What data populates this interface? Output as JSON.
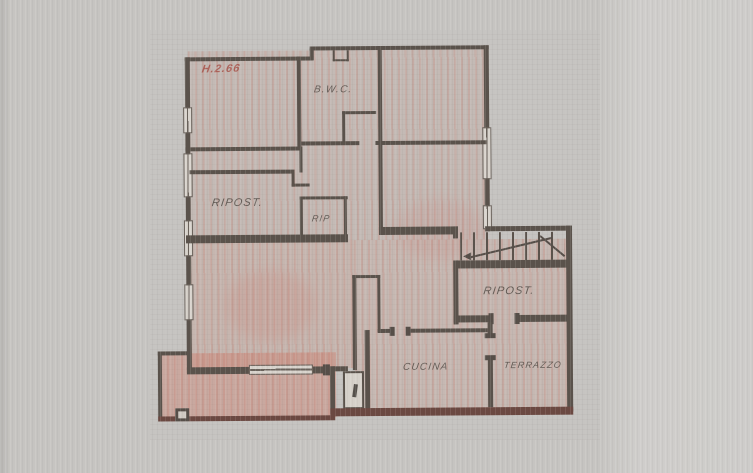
{
  "plan": {
    "annotation": {
      "text": "H.2.66",
      "color": "#a8544b"
    },
    "labels": {
      "bwc": "B.W.C.",
      "ripost_left": "RIPOST.",
      "rip": "RIP",
      "ripost_right": "RIPOST.",
      "cucina": "CUCINA",
      "terrazzo": "TERRAZZO"
    },
    "colors": {
      "paper": "#c6c4c1",
      "paper_right_band": "#cdccc9",
      "wall": "#5a524b",
      "wall_maroon": "#6b4841",
      "window_fill": "#d8d3cc",
      "room_tint": "#c98d7d",
      "label_text": "#574f49"
    }
  }
}
